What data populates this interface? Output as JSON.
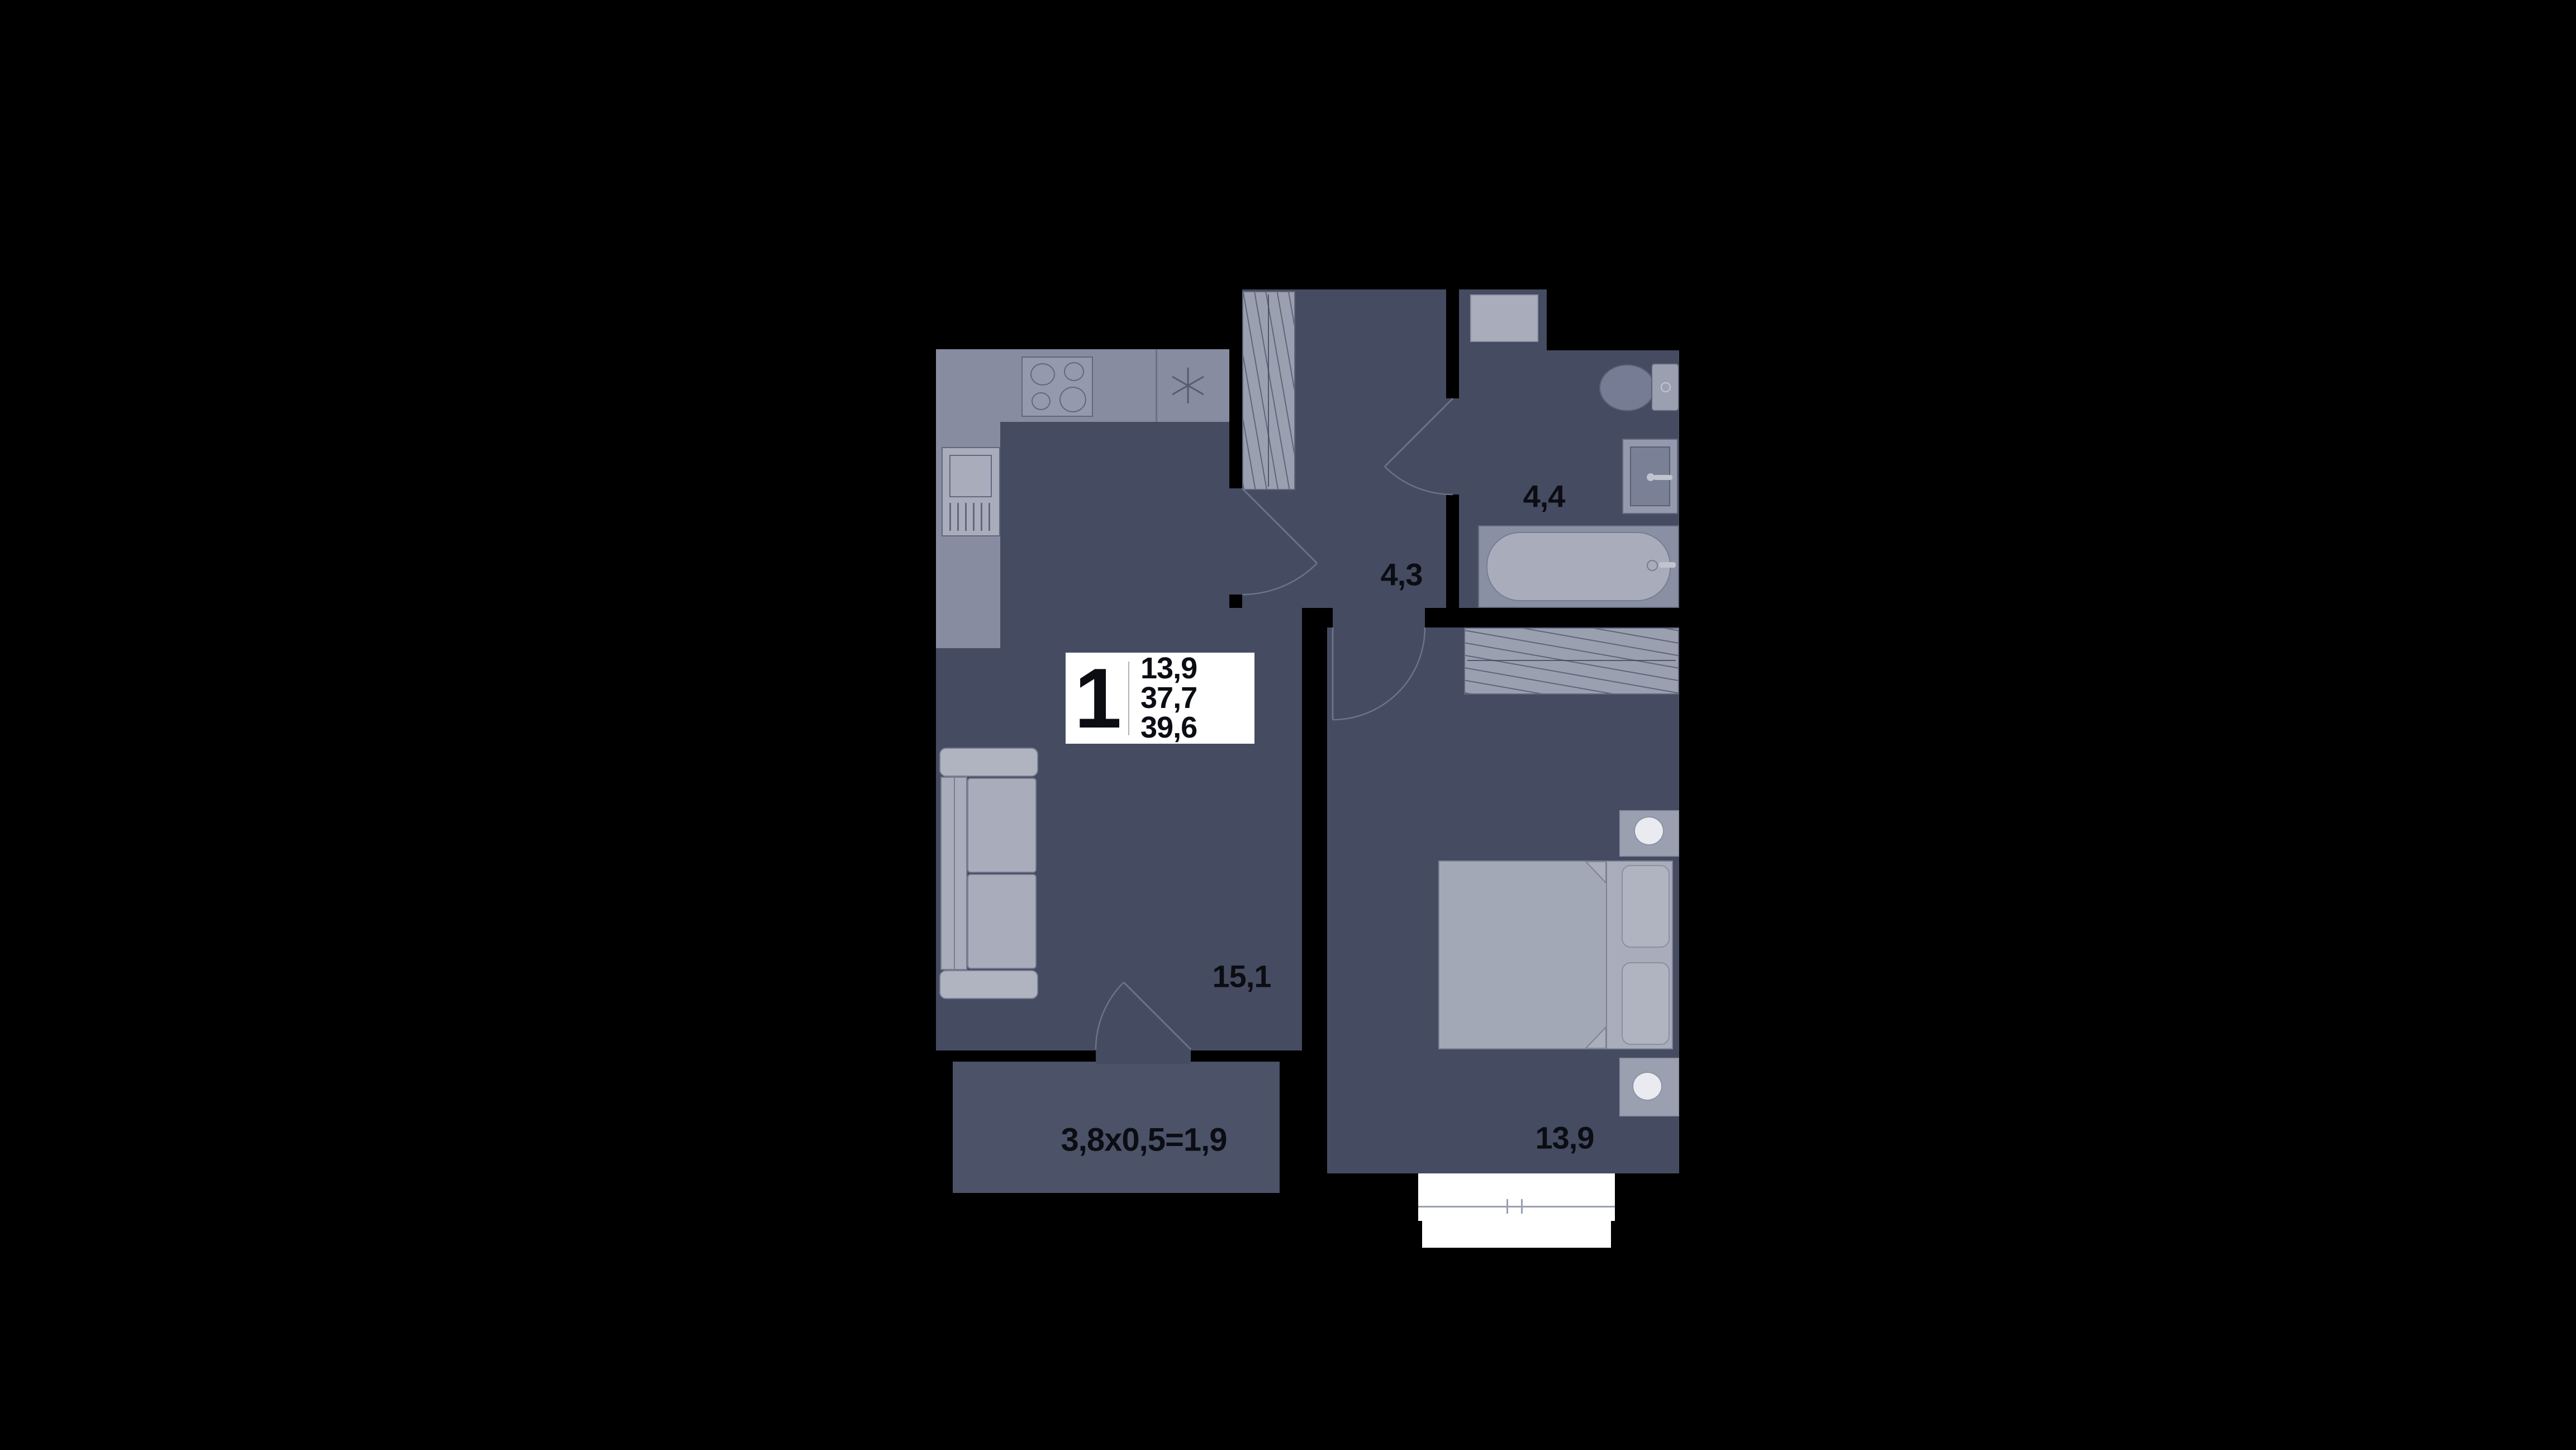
{
  "unit_card": {
    "rooms": "1",
    "living_area": "13,9",
    "area_excl_balcony": "37,7",
    "total_area": "39,6"
  },
  "rooms": {
    "living_kitchen": {
      "area": "15,1"
    },
    "hallway": {
      "area": "4,3"
    },
    "bathroom": {
      "area": "4,4"
    },
    "bedroom": {
      "area": "13,9"
    },
    "balcony": {
      "formula": "3,8x0,5=1,9"
    }
  },
  "icons": {
    "kitchen-sink-icon": "asterisk-star",
    "stove-icon": "four-burners",
    "lamp-icon": "circle"
  },
  "colors": {
    "bg": "#000000",
    "floor": "#454C61",
    "balcony": "#4C5368",
    "counter": "#878CA0",
    "furn": "#9BA0B1",
    "furn-light": "#A9ADBB",
    "lamp": "#E9EBF1",
    "white": "#FFFFFF",
    "ink": "#0B0D13"
  }
}
